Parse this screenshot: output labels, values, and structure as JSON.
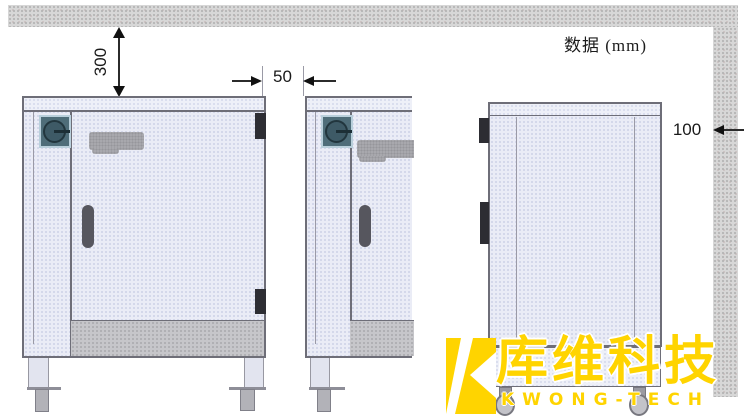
{
  "annotation": {
    "units_note": "数据 (mm)"
  },
  "dimensions": {
    "top_clearance_mm": "300",
    "between_units_mm": "50",
    "wall_clearance_mm": "100"
  },
  "drawing": {
    "views": [
      "front-view-unit",
      "front-view-unit-partial",
      "side-view-unit"
    ],
    "walls": [
      "ceiling-or-rear-wall",
      "right-side-wall"
    ]
  },
  "watermark": {
    "logo_text_cn": "库维科技",
    "logo_text_en": "KWONG-TECH",
    "brand_color": "#ffd400"
  },
  "colors": {
    "wall_hatch": "#d7d7d7",
    "panel_fill": "#eaecf6",
    "kick_plate": "#c6c6ca",
    "outline": "#6e6e78",
    "dimension_line": "#2b2b2b",
    "knob": "#3e5a66",
    "handle": "#56565e",
    "watermark_yellow": "#ffd400"
  }
}
